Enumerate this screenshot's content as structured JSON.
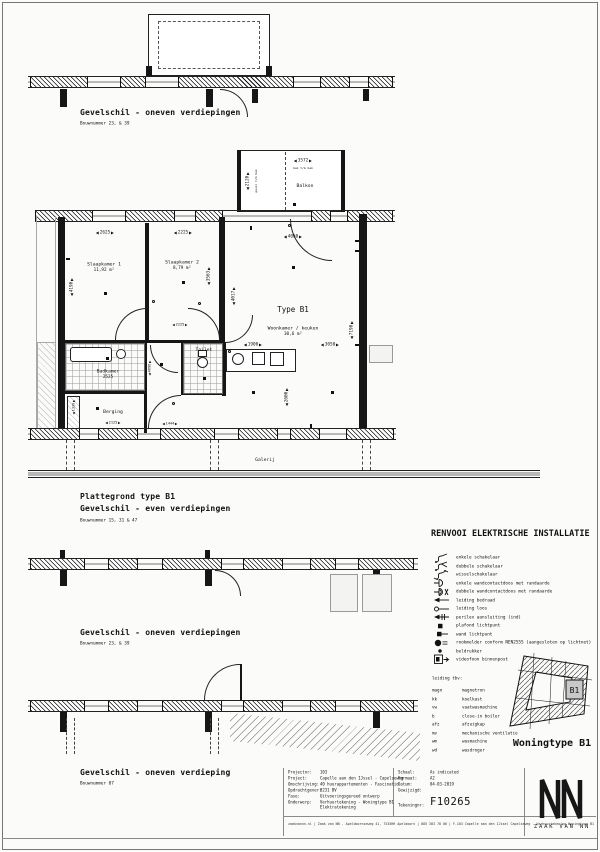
{
  "sections": {
    "facade_top": {
      "title": "Gevelschil - oneven verdiepingen",
      "subtitle": "Bouwnummer 23, & 39"
    },
    "plan_block": {
      "title": "Plattegrond type B1",
      "title2": "Gevelschil - even verdiepingen",
      "subtitle": "Bouwnummer 15, 31 & 47"
    },
    "facade_mid": {
      "title": "Gevelschil - oneven verdiepingen",
      "subtitle": "Bouwnummer 23, & 39"
    },
    "facade_bottom": {
      "title": "Gevelschil - oneven verdieping",
      "subtitle": "Bouwnummer 07"
    }
  },
  "plan": {
    "type_label": "Type B1",
    "rooms": {
      "slaapkamer1": {
        "name": "Slaapkamer 1",
        "area": "11,92 m²"
      },
      "slaapkamer2": {
        "name": "Slaapkamer 2",
        "area": "8,79 m²"
      },
      "woonkamer": {
        "name": "Woonkamer / keuken",
        "area": "30,6 m²"
      },
      "balkon": {
        "name": "Balkon"
      },
      "badkamer": {
        "name": "Badkamer",
        "dim": "2525"
      },
      "berging": {
        "name": "Berging"
      },
      "toilet": {
        "name": "Toilet"
      }
    },
    "galerij": "Galerij",
    "notes": {
      "balkon_w": "bak t/m bak",
      "balkon_h": "gevel t/m bak"
    },
    "dims": {
      "slk1_w": "2625",
      "slk2_w": "2225",
      "woon_w": "4060",
      "slk1_h": "4190",
      "slk2_h": "3563",
      "hal_h": "4017",
      "woon_h": "7190",
      "keuken_w": "1900",
      "woon_w2": "3050",
      "keuken_h": "2600",
      "hal_w": "2225",
      "berging_w": "2125",
      "entree_w": "1444",
      "balkon_w": "3572",
      "balkon_h": "2120",
      "hal_v": "4696",
      "berging_h": "1330"
    }
  },
  "legend": {
    "title": "RENVOOI ELEKTRISCHE INSTALLATIE",
    "items": [
      {
        "icon": "single-switch-icon",
        "label": "enkele schakelaar"
      },
      {
        "icon": "double-switch-icon",
        "label": "dubbele schakelaar"
      },
      {
        "icon": "two-way-switch-icon",
        "label": "wisselschakelaar"
      },
      {
        "icon": "single-socket-icon",
        "label": "enkele wandcontactdoos met randaarde"
      },
      {
        "icon": "double-socket-icon",
        "label": "dubbele wandcontactdoos met randaarde"
      },
      {
        "icon": "wired-conduit-icon",
        "label": "leiding bedraad"
      },
      {
        "icon": "empty-conduit-icon",
        "label": "leiding loos"
      },
      {
        "icon": "perilex-icon",
        "label": "perilex aansluiting (ind)"
      },
      {
        "icon": "ceiling-light-icon",
        "label": "plafond lichtpunt"
      },
      {
        "icon": "wall-light-icon",
        "label": "wand lichtpunt"
      },
      {
        "icon": "smoke-detector-icon",
        "label": "rookmelder conform NEN2555 (aangesloten op lichtnet)"
      },
      {
        "icon": "bell-button-icon",
        "label": "beldrukker"
      },
      {
        "icon": "intercom-icon",
        "label": "videofoon binnenpost"
      }
    ],
    "conduit_title": "leiding tbv:",
    "conduit_items": [
      {
        "abbr": "magn",
        "label": "magnetron"
      },
      {
        "abbr": "kk",
        "label": "koelkast"
      },
      {
        "abbr": "vw",
        "label": "vaatwasmachine"
      },
      {
        "abbr": "b",
        "label": "close-in boiler"
      },
      {
        "abbr": "afz",
        "label": "afzuigkap"
      },
      {
        "abbr": "mv",
        "label": "mechanische ventilatie"
      },
      {
        "abbr": "wm",
        "label": "wasmachine"
      },
      {
        "abbr": "wd",
        "label": "wasdroger"
      }
    ]
  },
  "site_key": {
    "unit": "B1",
    "label": "Woningtype B1"
  },
  "title_block": {
    "left": [
      {
        "label": "Projectnr:",
        "value": "103"
      },
      {
        "label": "Project:",
        "value": "Capelle aan den IJssel - Capelseweg"
      },
      {
        "label": "Omschrijving:",
        "value": "40 huurappartementen - Fascinatio"
      },
      {
        "label": "Opdrachtgever:",
        "value": "8231 BV"
      },
      {
        "label": "Fase:",
        "value": "Uitvoeringsgereed ontwerp"
      },
      {
        "label": "Onderwerp:",
        "value": "Verhuurtekening - Woningtype B1 Elektratekening"
      }
    ],
    "right": [
      {
        "label": "Schaal:",
        "value": "As indicated"
      },
      {
        "label": "Formaat:",
        "value": "A2"
      },
      {
        "label": "Datum:",
        "value": "04-03-2019"
      },
      {
        "label": "Gewijzigd:",
        "value": ""
      },
      {
        "label": "Tekeningnr:",
        "value": "F10265"
      }
    ],
    "drawing_number": "F10265",
    "footer": "zaakvannn.nl   |   Zaak van NN - Apeldoornseweg 41, 7535HH Apeldoorn   |   085 303 78 06   |   F-103 Capelle aan den IJssel Capelseweg - Verhuurtekening Woningtype B1"
  },
  "logo": {
    "mark": "NN",
    "name": "ZAAK VAN NN"
  }
}
